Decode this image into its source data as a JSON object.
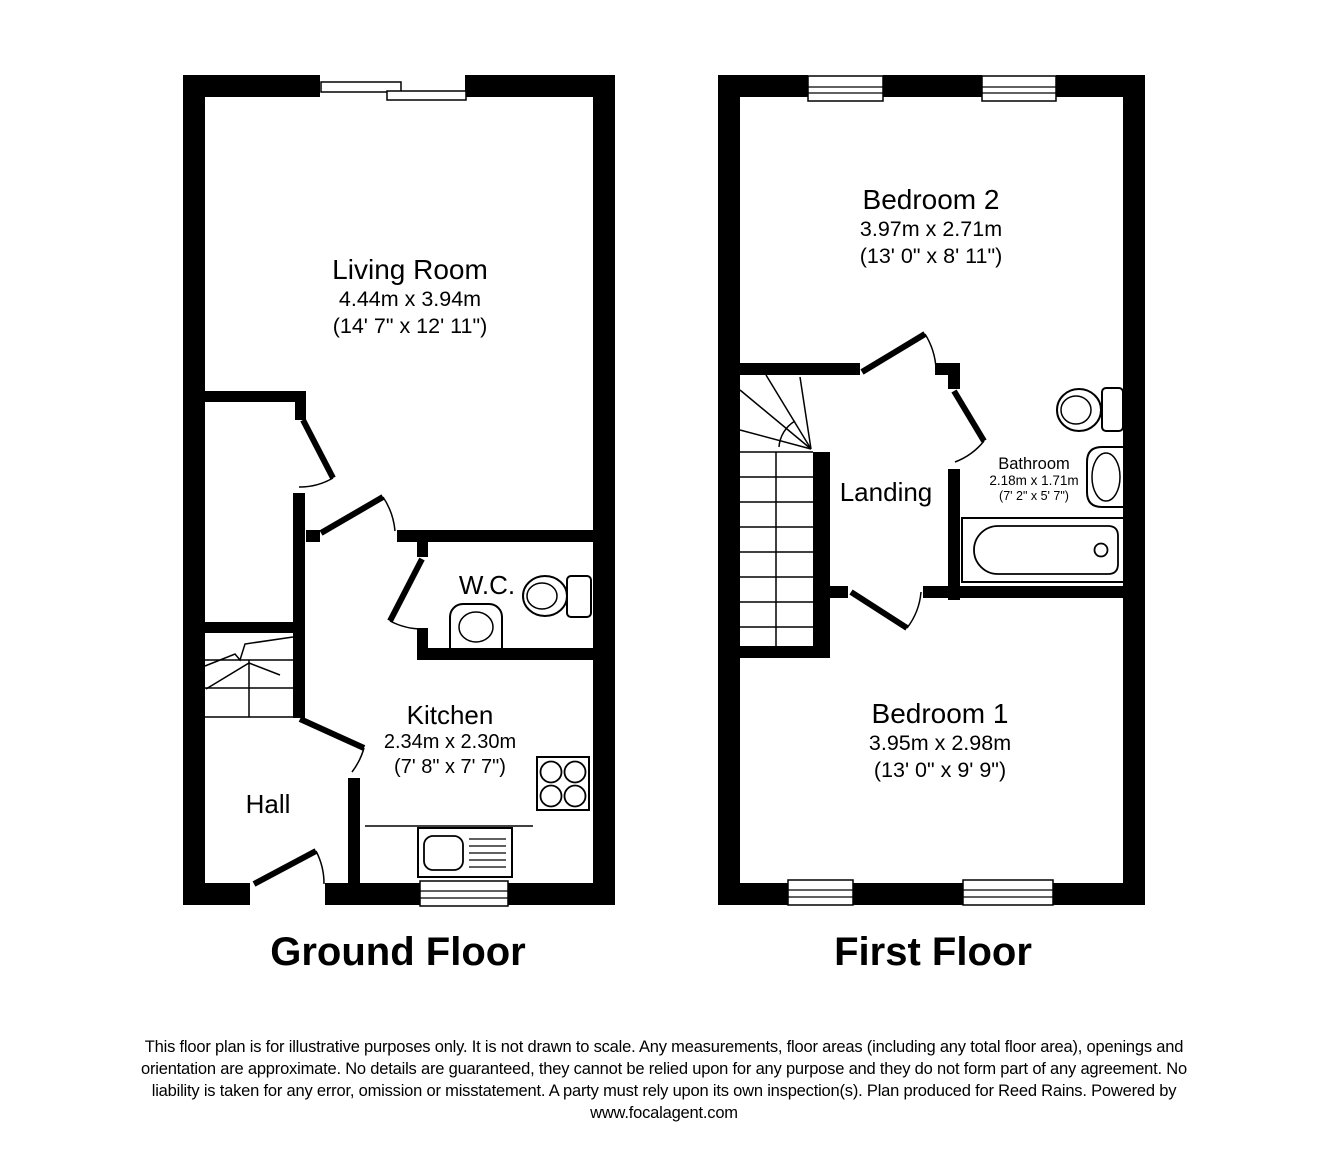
{
  "ground_floor": {
    "title": "Ground Floor",
    "rooms": {
      "living_room": {
        "name": "Living Room",
        "dims_m": "4.44m x 3.94m",
        "dims_ft": "(14' 7\" x 12' 11\")"
      },
      "wc": {
        "name": "W.C."
      },
      "kitchen": {
        "name": "Kitchen",
        "dims_m": "2.34m x 2.30m",
        "dims_ft": "(7' 8\" x 7' 7\")"
      },
      "hall": {
        "name": "Hall"
      }
    }
  },
  "first_floor": {
    "title": "First Floor",
    "rooms": {
      "bedroom_2": {
        "name": "Bedroom 2",
        "dims_m": "3.97m x 2.71m",
        "dims_ft": "(13' 0\" x 8' 11\")"
      },
      "landing": {
        "name": "Landing"
      },
      "bathroom": {
        "name": "Bathroom",
        "dims_m": "2.18m x 1.71m",
        "dims_ft": "(7' 2\" x 5' 7\")"
      },
      "bedroom_1": {
        "name": "Bedroom 1",
        "dims_m": "3.95m x 2.98m",
        "dims_ft": "(13' 0\" x 9' 9\")"
      }
    }
  },
  "disclaimer": {
    "lines": [
      "This floor plan is for illustrative purposes only. It is not drawn to scale. Any measurements, floor areas (including any total floor area), openings and",
      "orientation are approximate. No details are guaranteed, they cannot be relied upon for any purpose and they do not form part of any agreement. No",
      "liability is taken for any error, omission or misstatement. A party must rely upon its own inspection(s). Plan produced for Reed Rains. Powered by",
      "www.focalagent.com"
    ]
  },
  "colors": {
    "wall": "#000000",
    "background": "#ffffff",
    "text": "#000000"
  }
}
